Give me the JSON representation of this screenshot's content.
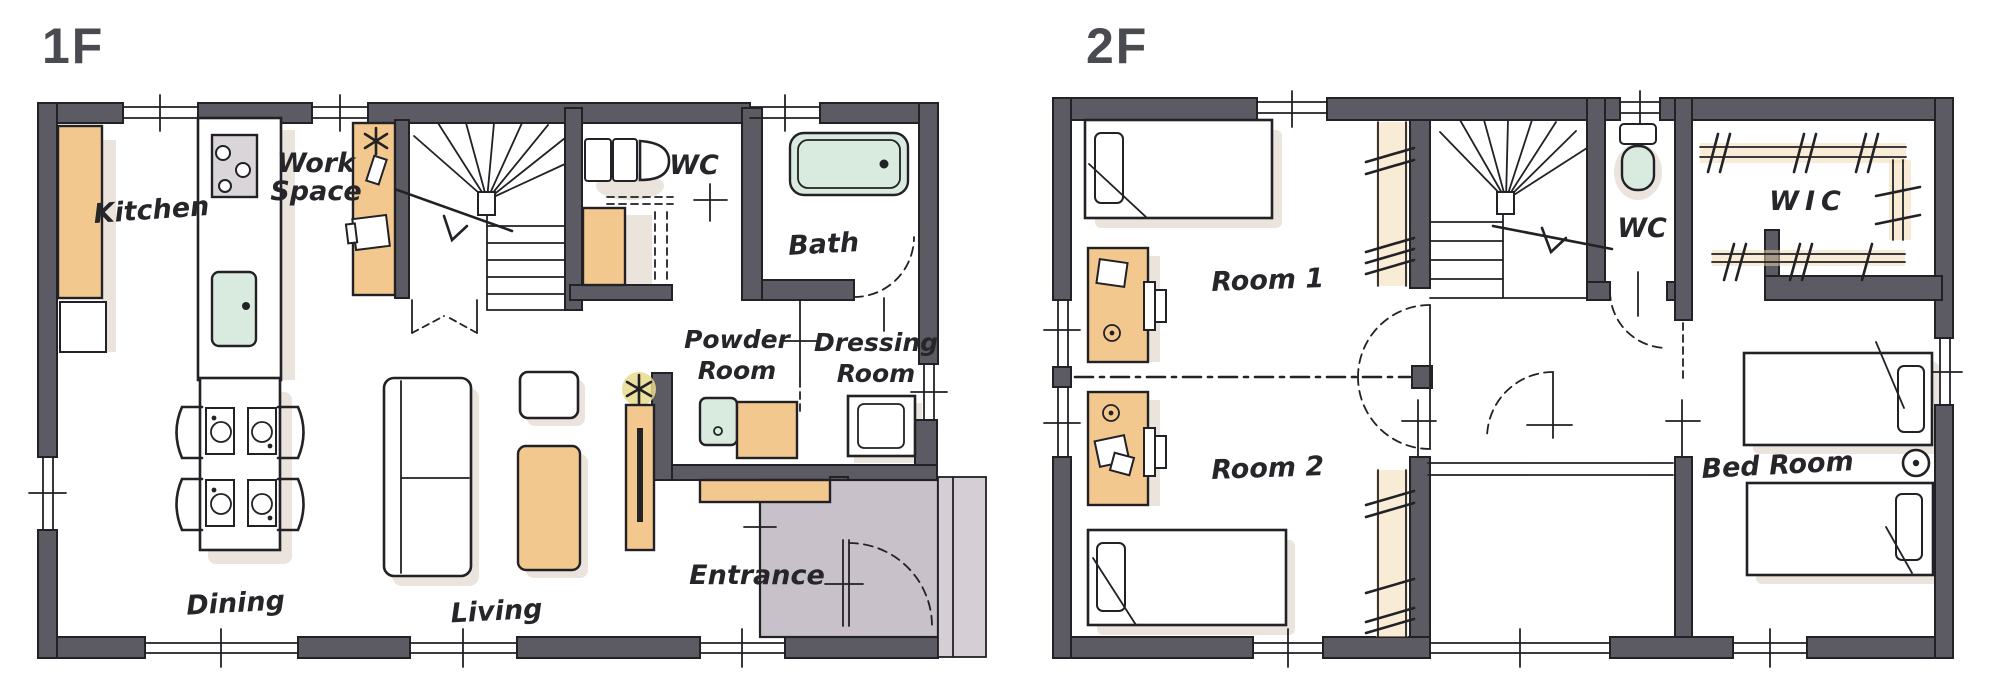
{
  "meta": {
    "type": "floor-plan",
    "floors": [
      {
        "name": "1F",
        "rooms": [
          "Kitchen",
          "Work Space",
          "WC",
          "Bath",
          "Powder Room",
          "Dressing Room",
          "Dining",
          "Living",
          "Entrance"
        ]
      },
      {
        "name": "2F",
        "rooms": [
          "Room 1",
          "Room 2",
          "WC",
          "WIC",
          "Bed Room"
        ]
      }
    ]
  },
  "labels": {
    "floor1": "1F",
    "floor2": "2F",
    "kitchen": "Kitchen",
    "work1": "Work",
    "work2": "Space",
    "wc1": "WC",
    "bath": "Bath",
    "powder1": "Powder",
    "powder2": "Room",
    "dressing1": "Dressing",
    "dressing2": "Room",
    "dining": "Dining",
    "living": "Living",
    "entrance": "Entrance",
    "room1": "Room 1",
    "room2": "Room 2",
    "wc2": "WC",
    "wic": "WIC",
    "bedroom": "Bed Room"
  },
  "colors": {
    "wall": "#5c5b63",
    "line": "#212126",
    "tan": "#f3c88e",
    "tan_tint": "#f2d9ae",
    "mint": "#d9ebdf",
    "entrance": "#c8c1c9",
    "porch": "#d5cfd5",
    "shadow": "#dcd2c5",
    "stove": "#d9d5d8",
    "halo": "#e9da8e",
    "title": "#4a4a51",
    "label": "#26262a"
  }
}
